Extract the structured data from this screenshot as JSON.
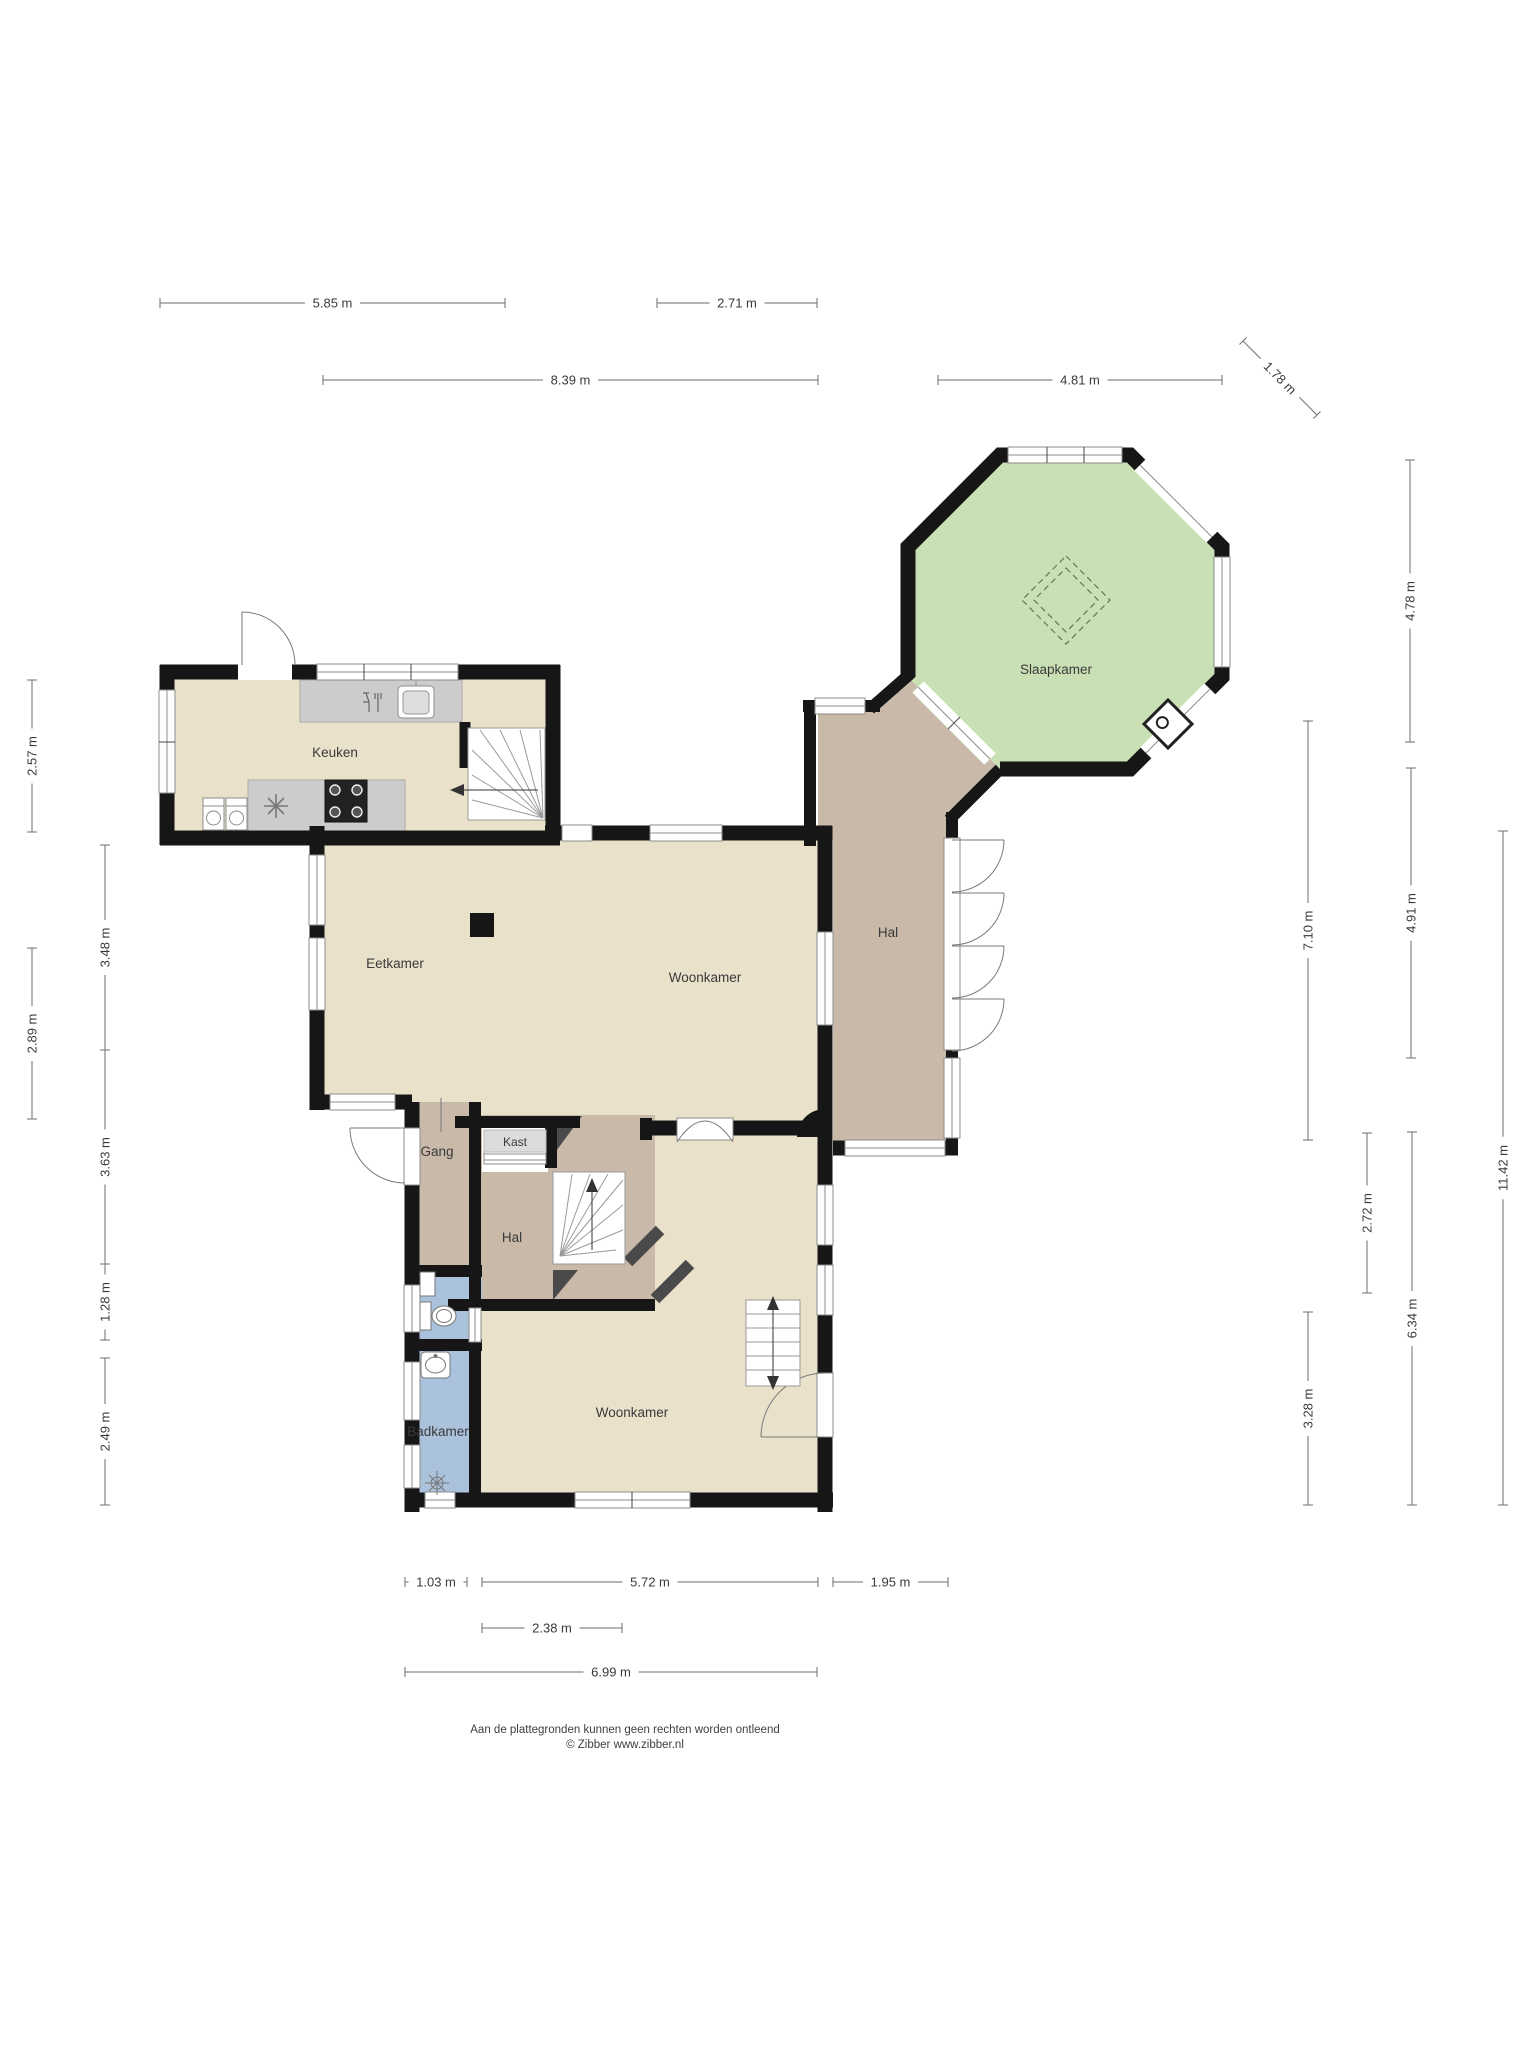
{
  "plan_title": "Begane grond plattegrond",
  "rooms": {
    "keuken": {
      "label": "Keuken"
    },
    "eetkamer": {
      "label": "Eetkamer"
    },
    "woonkamer": {
      "label": "Woonkamer"
    },
    "hal": {
      "label": "Hal"
    },
    "slaapkamer": {
      "label": "Slaapkamer"
    },
    "gang": {
      "label": "Gang"
    },
    "kast": {
      "label": "Kast"
    },
    "hal2": {
      "label": "Hal"
    },
    "badkamer": {
      "label": "Badkamer"
    },
    "woonkamer2": {
      "label": "Woonkamer"
    }
  },
  "measurements": [
    {
      "id": "top-5-85",
      "label": "5.85 m",
      "x1": 160,
      "y1": 303,
      "x2": 505,
      "y2": 303,
      "dir": "h"
    },
    {
      "id": "top-2-71",
      "label": "2.71 m",
      "x1": 657,
      "y1": 303,
      "x2": 817,
      "y2": 303,
      "dir": "h"
    },
    {
      "id": "top-8-39",
      "label": "8.39 m",
      "x1": 323,
      "y1": 380,
      "x2": 818,
      "y2": 380,
      "dir": "h"
    },
    {
      "id": "top-4-81",
      "label": "4.81 m",
      "x1": 938,
      "y1": 380,
      "x2": 1222,
      "y2": 380,
      "dir": "h"
    },
    {
      "id": "diag-1-78",
      "label": "1.78 m",
      "x1": 1243,
      "y1": 341,
      "x2": 1317,
      "y2": 415,
      "dir": "d"
    },
    {
      "id": "left-2-57",
      "label": "2.57 m",
      "x1": 32,
      "y1": 680,
      "x2": 32,
      "y2": 832,
      "dir": "v"
    },
    {
      "id": "left-3-48",
      "label": "3.48 m",
      "x1": 105,
      "y1": 845,
      "x2": 105,
      "y2": 1050,
      "dir": "v"
    },
    {
      "id": "left-2-89",
      "label": "2.89 m",
      "x1": 32,
      "y1": 948,
      "x2": 32,
      "y2": 1119,
      "dir": "v"
    },
    {
      "id": "left-3-63",
      "label": "3.63 m",
      "x1": 105,
      "y1": 1050,
      "x2": 105,
      "y2": 1264,
      "dir": "v"
    },
    {
      "id": "left-1-28",
      "label": "1.28 m",
      "x1": 105,
      "y1": 1264,
      "x2": 105,
      "y2": 1340,
      "dir": "v"
    },
    {
      "id": "left-2-49",
      "label": "2.49 m",
      "x1": 105,
      "y1": 1358,
      "x2": 105,
      "y2": 1505,
      "dir": "v"
    },
    {
      "id": "right-4-78",
      "label": "4.78 m",
      "x1": 1410,
      "y1": 460,
      "x2": 1410,
      "y2": 742,
      "dir": "v"
    },
    {
      "id": "right-7-10",
      "label": "7.10 m",
      "x1": 1308,
      "y1": 721,
      "x2": 1308,
      "y2": 1140,
      "dir": "v"
    },
    {
      "id": "right-4-91",
      "label": "4.91 m",
      "x1": 1411,
      "y1": 768,
      "x2": 1411,
      "y2": 1058,
      "dir": "v"
    },
    {
      "id": "right-11-42",
      "label": "11.42 m",
      "x1": 1503,
      "y1": 831,
      "x2": 1503,
      "y2": 1505,
      "dir": "v"
    },
    {
      "id": "right-2-72",
      "label": "2.72 m",
      "x1": 1367,
      "y1": 1133,
      "x2": 1367,
      "y2": 1293,
      "dir": "v"
    },
    {
      "id": "right-6-34",
      "label": "6.34 m",
      "x1": 1412,
      "y1": 1132,
      "x2": 1412,
      "y2": 1505,
      "dir": "v"
    },
    {
      "id": "right-3-28",
      "label": "3.28 m",
      "x1": 1308,
      "y1": 1312,
      "x2": 1308,
      "y2": 1505,
      "dir": "v"
    },
    {
      "id": "bot-1-03",
      "label": "1.03 m",
      "x1": 405,
      "y1": 1582,
      "x2": 467,
      "y2": 1582,
      "dir": "h"
    },
    {
      "id": "bot-5-72",
      "label": "5.72 m",
      "x1": 482,
      "y1": 1582,
      "x2": 818,
      "y2": 1582,
      "dir": "h"
    },
    {
      "id": "bot-1-95",
      "label": "1.95 m",
      "x1": 833,
      "y1": 1582,
      "x2": 948,
      "y2": 1582,
      "dir": "h"
    },
    {
      "id": "bot-2-38",
      "label": "2.38 m",
      "x1": 482,
      "y1": 1628,
      "x2": 622,
      "y2": 1628,
      "dir": "h"
    },
    {
      "id": "bot-6-99",
      "label": "6.99 m",
      "x1": 405,
      "y1": 1672,
      "x2": 817,
      "y2": 1672,
      "dir": "h"
    }
  ],
  "footer": {
    "line1": "Aan de plattegronden kunnen geen rechten worden ontleend",
    "line2": "© Zibber www.zibber.nl"
  },
  "colors": {
    "wall": "#161616",
    "dark_wall": "#4a4a4a",
    "floor_living": "#e9e1ca",
    "floor_hall": "#c8b9a9",
    "floor_bedroom": "#c9dfb4",
    "floor_bath": "#abc2dd",
    "counter": "#cccccc",
    "window_frame": "#8c8c8c",
    "dim_line": "#6e6e6e",
    "text": "#3a3a3a"
  },
  "icons": {
    "dishwasher": "glass-and-cutlery",
    "sink": "basin-with-faucet",
    "stove": "four-burner-cooktop",
    "freezer": "snowflake",
    "washing-machine": "drum-circle",
    "toilet": "bowl-and-cistern",
    "washbasin": "oval-basin",
    "shower": "drain-star",
    "wood-stove": "rotated-square-flue",
    "skylight": "dashed-diamond",
    "stairs": "fanned-treads-arrow"
  }
}
